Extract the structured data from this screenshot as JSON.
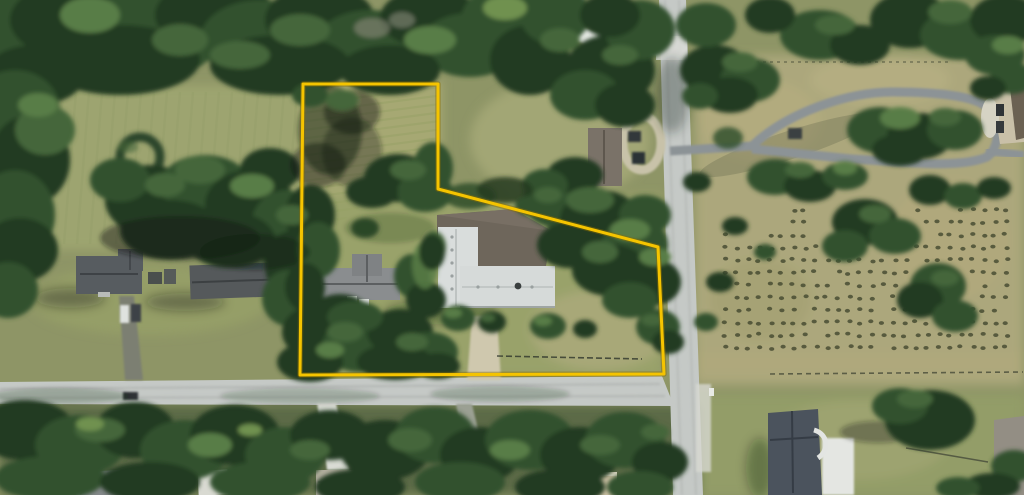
{
  "scene": {
    "kind": "satellite-aerial-photograph",
    "width_px": 1024,
    "height_px": 495
  },
  "overlay": {
    "parcel_boundary": {
      "color": "#F5C400",
      "outline_color": "#8A6D00",
      "stroke_width": 3,
      "points": [
        [
          303,
          84
        ],
        [
          438,
          84
        ],
        [
          438,
          189
        ],
        [
          658,
          247
        ],
        [
          664,
          374
        ],
        [
          300,
          375
        ]
      ]
    }
  },
  "orchard": {
    "x_start": 726,
    "x_end": 1016,
    "x_step": 11.2,
    "y_start": 210,
    "y_end": 350,
    "y_step": 12.5,
    "dot_color": "#42472E",
    "dot_opacity": 0.8
  },
  "palette": {
    "field_base": "#8E9566",
    "field_topleft": "#9DA46F",
    "field_parcel_upper": "#A6A873",
    "field_right": "#ACA77B",
    "lawn_bottom_right": "#939D67",
    "ground_under_trees": "#5C6B47",
    "road_gray": "#C5C9C6",
    "asphalt_loop": "#8C9396",
    "concrete_white": "#E9EBE7",
    "gravel_circle": "#C8C2A9",
    "drive_beige": "#CFC8AE",
    "tree_dark": "#243A22",
    "tree_mid": "#33512E",
    "tree_light": "#45663B",
    "tree_highlight": "#587D46",
    "shadow": "#101D12",
    "roof_main_white": "#D9DDDC",
    "roof_main_brown": "#6E665B",
    "roof_dark_gray": "#575C60",
    "roof_slate_blue": "#4B535D"
  }
}
